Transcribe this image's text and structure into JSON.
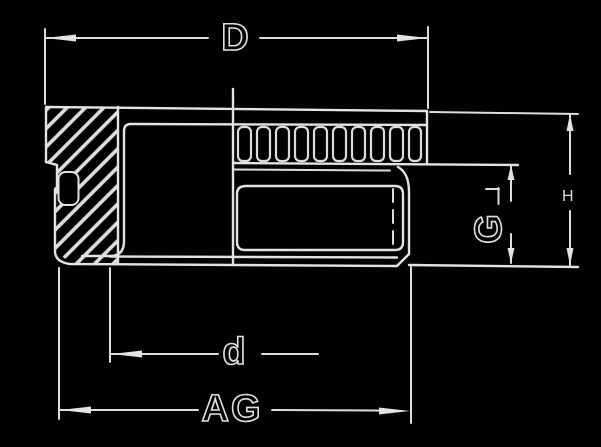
{
  "drawing": {
    "description": "Technical cross-section drawing (inverted scan, white lines on black) of a threaded gland fitting with hex flange, external thread band and internal bore",
    "colors": {
      "background": "#010101",
      "line": "#e3e3e3"
    },
    "labels": {
      "width_top": "D",
      "width_inner": "d",
      "width_bottom": "AG",
      "height_mid": "G",
      "height_right": "H"
    }
  }
}
